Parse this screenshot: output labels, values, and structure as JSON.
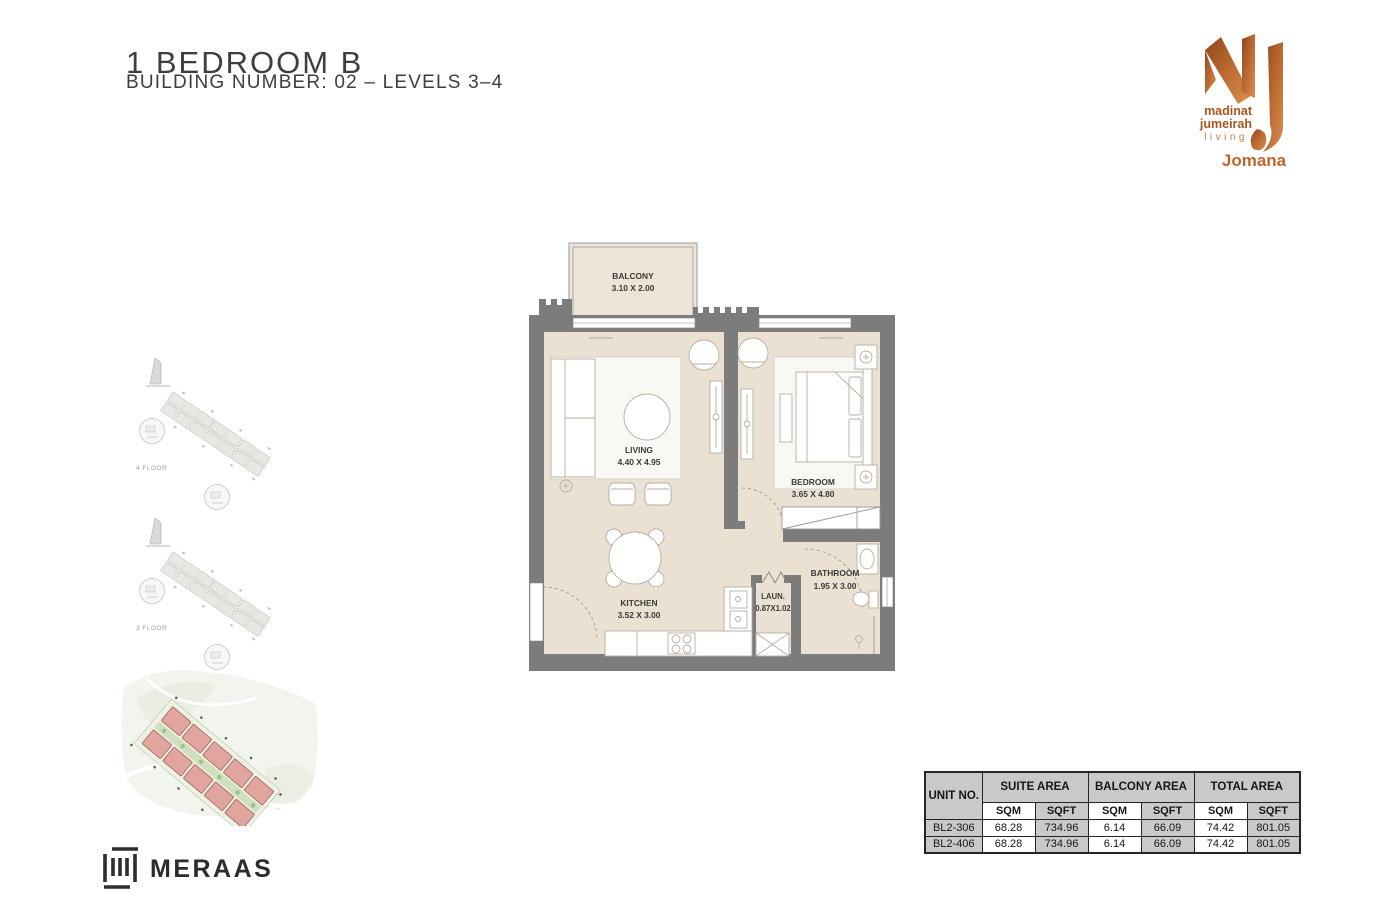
{
  "header": {
    "title": "1 BEDROOM B",
    "subtitle": "BUILDING NUMBER: 02 – LEVELS 3–4"
  },
  "brand": {
    "name_line1": "madinat",
    "name_line2": "jumeirah",
    "name_line3": "living",
    "project": "Jomana",
    "copper": "#bf662e"
  },
  "keyplans": [
    {
      "label": "4 FLOOR"
    },
    {
      "label": "3 FLOOR"
    }
  ],
  "floorplan": {
    "colors": {
      "floor": "#ebe1d2",
      "wall": "#7c7c7c"
    },
    "rooms": [
      {
        "name": "BALCONY",
        "dims": "3.10 X 2.00"
      },
      {
        "name": "LIVING",
        "dims": "4.40 X 4.95"
      },
      {
        "name": "BEDROOM",
        "dims": "3.65 X 4.80"
      },
      {
        "name": "KITCHEN",
        "dims": "3.52 X 3.00"
      },
      {
        "name": "LAUN.",
        "dims": "0.87X1.02"
      },
      {
        "name": "BATHROOM",
        "dims": "1.95 X 3.00"
      }
    ]
  },
  "area_table": {
    "unit_col_header": "UNIT NO.",
    "groups": [
      {
        "label": "SUITE AREA"
      },
      {
        "label": "BALCONY AREA"
      },
      {
        "label": "TOTAL AREA"
      }
    ],
    "sub_headers": [
      "SQM",
      "SQFT",
      "SQM",
      "SQFT",
      "SQM",
      "SQFT"
    ],
    "rows": [
      {
        "unit": "BL2-306",
        "values": [
          "68.28",
          "734.96",
          "6.14",
          "66.09",
          "74.42",
          "801.05"
        ]
      },
      {
        "unit": "BL2-406",
        "values": [
          "68.28",
          "734.96",
          "6.14",
          "66.09",
          "74.42",
          "801.05"
        ]
      }
    ]
  },
  "footer": {
    "developer": "MERAAS"
  }
}
